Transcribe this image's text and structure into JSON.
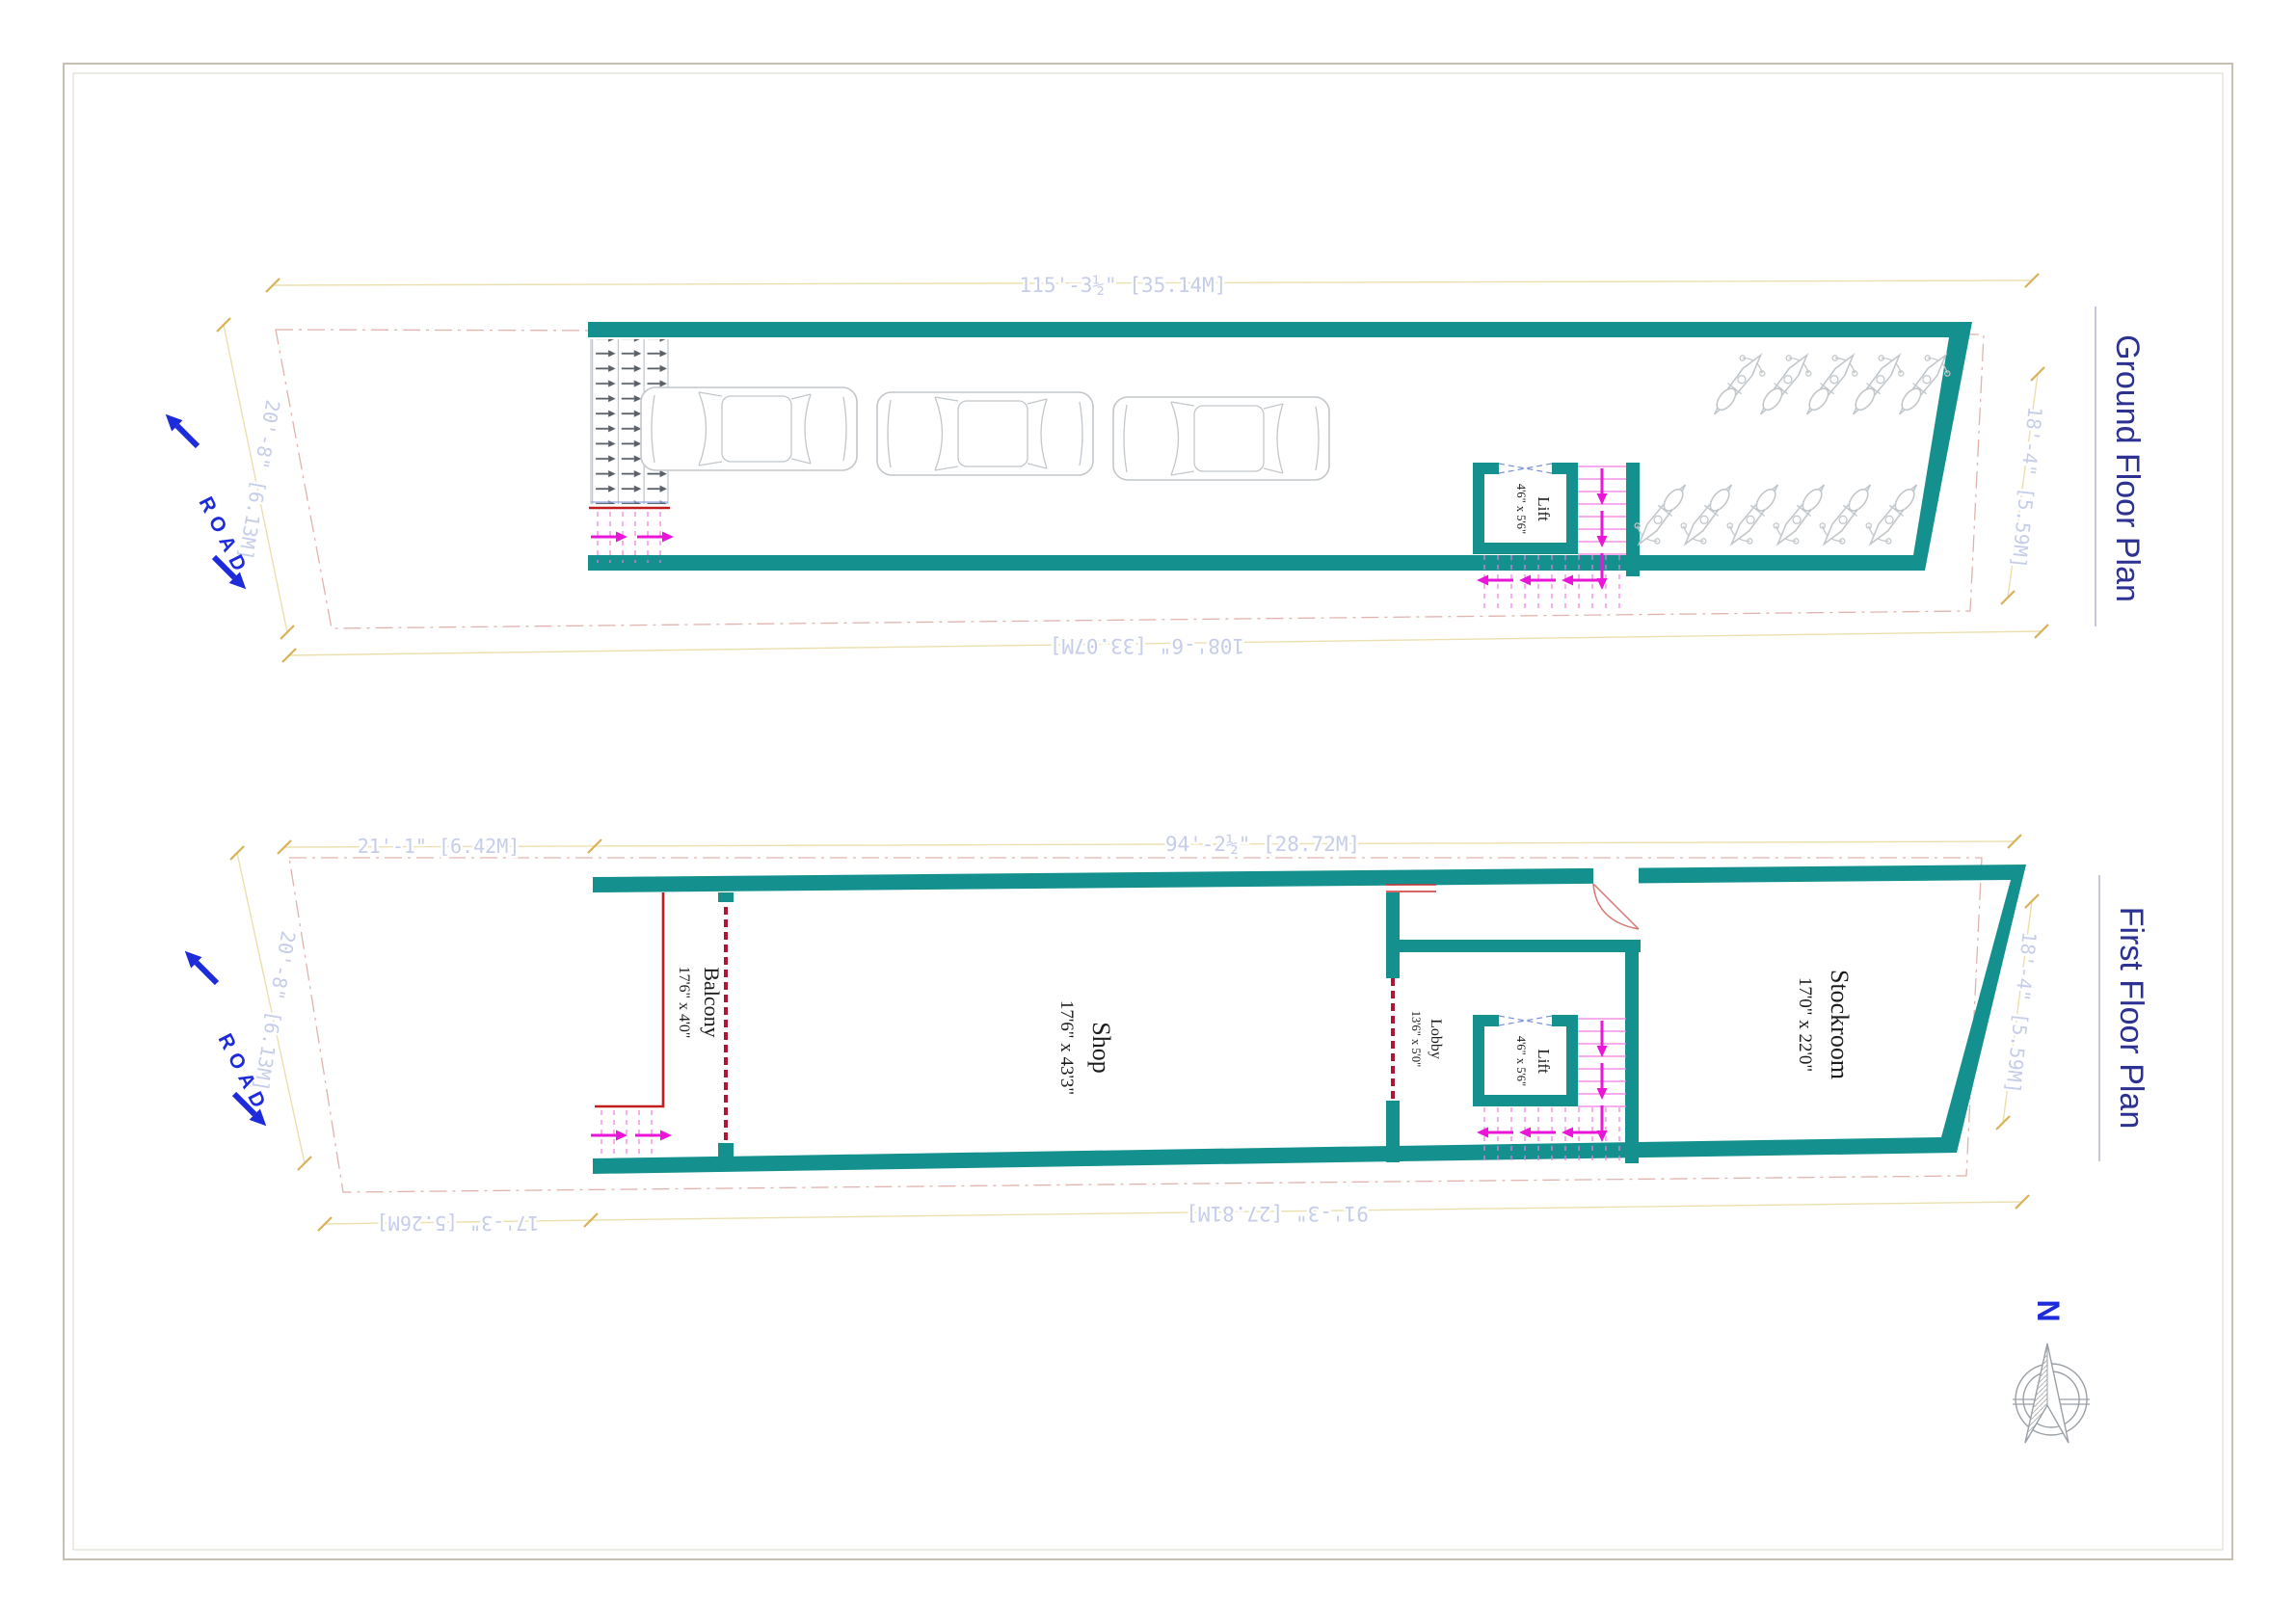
{
  "titles": {
    "ground": "Ground Floor Plan",
    "first": "First Floor Plan"
  },
  "compass": {
    "north_label": "N"
  },
  "ground_floor": {
    "road_label": "ROAD",
    "dim_top": "115'-3½\" [35.14M]",
    "dim_bottom": "108'-6\" [33.07M]",
    "dim_left": "20'-8\" [6.13M]",
    "dim_right": "18'-4\" [5.59M]",
    "lift_label": "Lift",
    "lift_size": "4'6\" x 5'6\""
  },
  "first_floor": {
    "road_label": "ROAD",
    "dim_top_left": "21'-1\" [6.42M]",
    "dim_top_right": "94'-2½\" [28.72M]",
    "dim_bottom_left": "17'-3\" [5.26M]",
    "dim_bottom_right": "91'-3\" [27.81M]",
    "dim_left": "20'-8\" [6.13M]",
    "dim_right": "18'-4\" [5.59M]",
    "balcony_label": "Balcony",
    "balcony_size": "17'6\" x 4'0\"",
    "shop_label": "Shop",
    "shop_size": "17'6\" x 43'3\"",
    "lobby_label": "Lobby",
    "lobby_size": "13'6\" x 5'0\"",
    "lift_label": "Lift",
    "lift_size": "4'6\" x 5'6\"",
    "stockroom_label": "Stockroom",
    "stockroom_size": "17'0\" x 22'0\""
  },
  "colors": {
    "wall_teal": "#14918f",
    "stair_magenta": "#ea15d8",
    "railing_red": "#c21d1d",
    "title_blue": "#2c3192",
    "road_blue": "#1d2bdb",
    "dim_text": "#c6cde9",
    "dim_line": "#e8d9a8"
  }
}
